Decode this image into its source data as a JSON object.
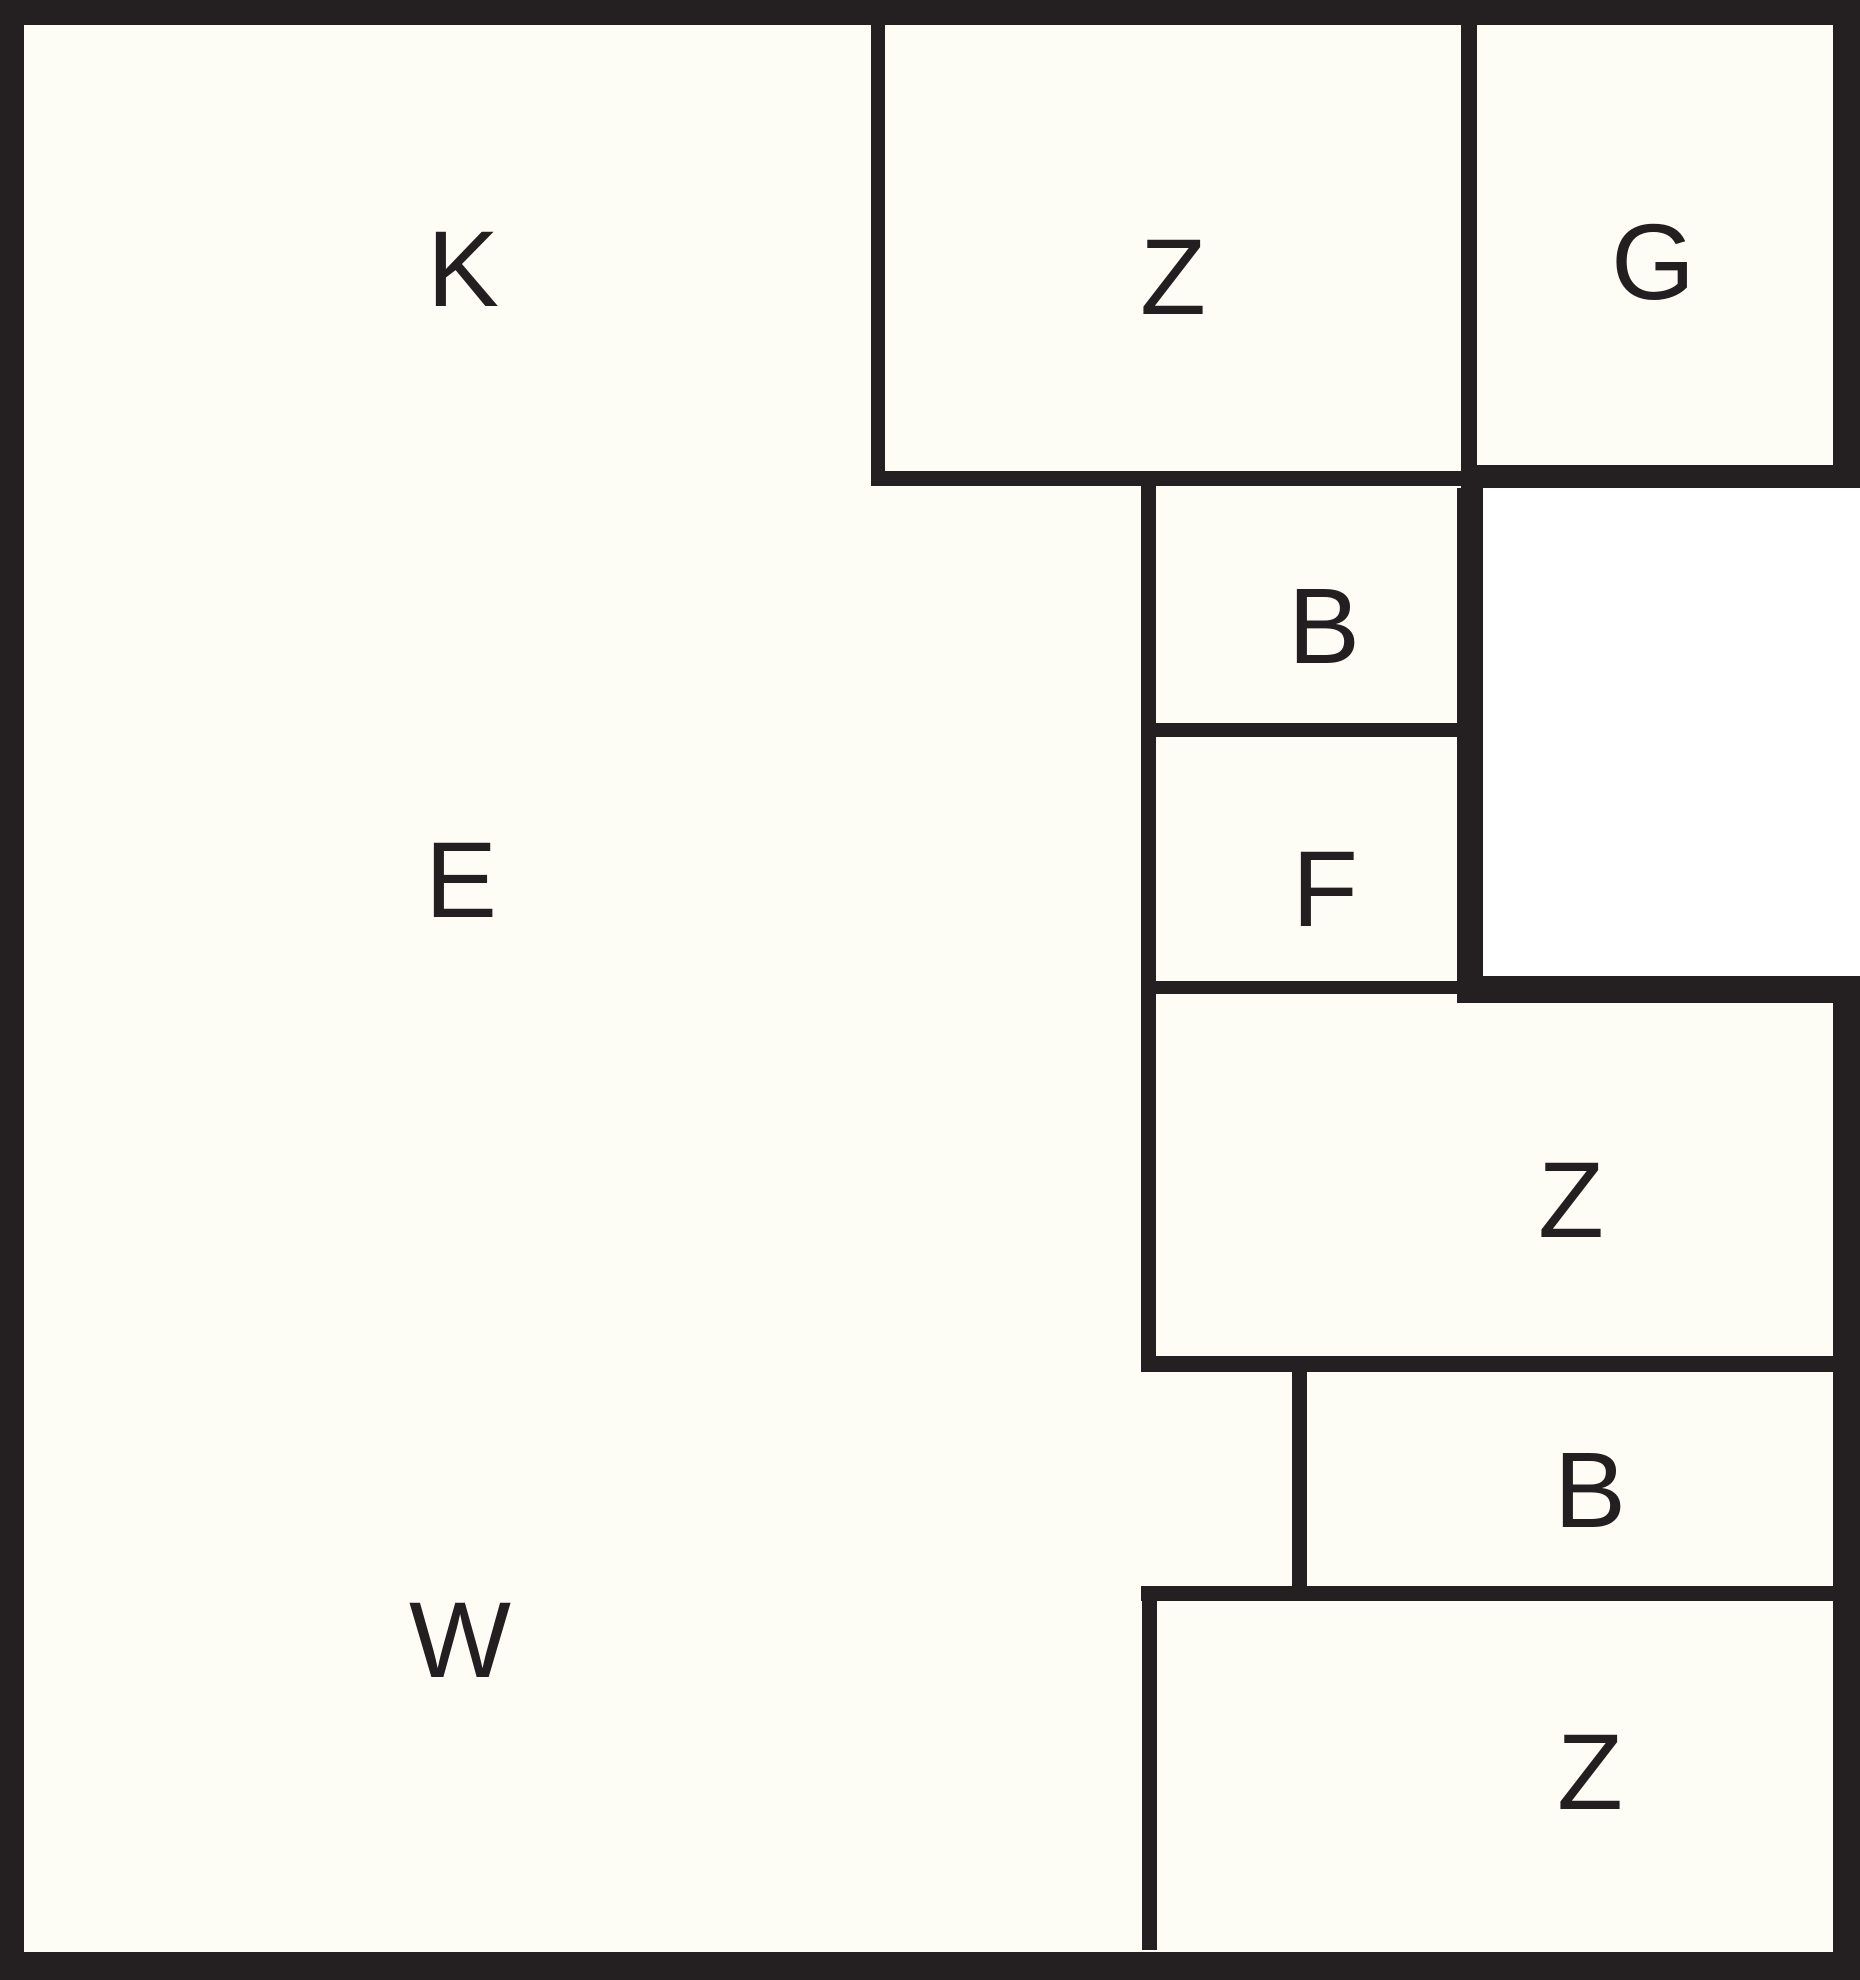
{
  "canvas": {
    "width": 1860,
    "height": 1980
  },
  "colors": {
    "wall": "#241f20",
    "floor": "#fdfdf5",
    "exterior": "#ffffff",
    "label_text": "#231f20"
  },
  "regions": [
    {
      "name": "floor-interior",
      "x": 24,
      "y": 25,
      "w": 1809,
      "h": 1927,
      "fill": "floor"
    },
    {
      "name": "exterior-notch",
      "x": 1483,
      "y": 488,
      "w": 377,
      "h": 488,
      "fill": "exterior"
    }
  ],
  "walls": [
    {
      "name": "outer-wall-top",
      "x": 0,
      "y": 0,
      "w": 1860,
      "h": 25
    },
    {
      "name": "outer-wall-left",
      "x": 0,
      "y": 0,
      "w": 24,
      "h": 1980
    },
    {
      "name": "outer-wall-bottom",
      "x": 0,
      "y": 1952,
      "w": 1860,
      "h": 28
    },
    {
      "name": "outer-wall-right-upper",
      "x": 1833,
      "y": 0,
      "w": 27,
      "h": 488
    },
    {
      "name": "outer-wall-right-lower",
      "x": 1833,
      "y": 976,
      "w": 27,
      "h": 1004
    },
    {
      "name": "wall-k-z",
      "x": 871,
      "y": 25,
      "w": 14,
      "h": 446
    },
    {
      "name": "wall-below-top-z",
      "x": 871,
      "y": 471,
      "w": 590,
      "h": 15
    },
    {
      "name": "wall-z-g",
      "x": 1461,
      "y": 25,
      "w": 16,
      "h": 440
    },
    {
      "name": "wall-below-g",
      "x": 1461,
      "y": 465,
      "w": 399,
      "h": 23
    },
    {
      "name": "wall-bf-left",
      "x": 1141,
      "y": 486,
      "w": 15,
      "h": 870
    },
    {
      "name": "wall-b-f-divider",
      "x": 1156,
      "y": 723,
      "w": 301,
      "h": 14
    },
    {
      "name": "wall-below-f",
      "x": 1156,
      "y": 981,
      "w": 301,
      "h": 13
    },
    {
      "name": "wall-bf-right",
      "x": 1457,
      "y": 488,
      "w": 26,
      "h": 515
    },
    {
      "name": "wall-mid-z-top",
      "x": 1457,
      "y": 976,
      "w": 403,
      "h": 27
    },
    {
      "name": "wall-mid-z-bottom",
      "x": 1141,
      "y": 1356,
      "w": 692,
      "h": 16
    },
    {
      "name": "wall-lower-b-left",
      "x": 1292,
      "y": 1372,
      "w": 15,
      "h": 214
    },
    {
      "name": "wall-lower-b-bottom",
      "x": 1141,
      "y": 1586,
      "w": 692,
      "h": 15
    },
    {
      "name": "wall-bottom-z-left",
      "x": 1142,
      "y": 1601,
      "w": 15,
      "h": 349
    }
  ],
  "labels": [
    {
      "name": "room-label-k",
      "text": "K",
      "x": 463,
      "y": 269
    },
    {
      "name": "room-label-top-z",
      "text": "Z",
      "x": 1173,
      "y": 277
    },
    {
      "name": "room-label-g",
      "text": "G",
      "x": 1653,
      "y": 262
    },
    {
      "name": "room-label-upper-b",
      "text": "B",
      "x": 1324,
      "y": 626
    },
    {
      "name": "room-label-e",
      "text": "E",
      "x": 461,
      "y": 880
    },
    {
      "name": "room-label-f",
      "text": "F",
      "x": 1325,
      "y": 889
    },
    {
      "name": "room-label-mid-z",
      "text": "Z",
      "x": 1571,
      "y": 1200
    },
    {
      "name": "room-label-lower-b",
      "text": "B",
      "x": 1590,
      "y": 1490
    },
    {
      "name": "room-label-w",
      "text": "W",
      "x": 460,
      "y": 1640
    },
    {
      "name": "room-label-bottom-z",
      "text": "Z",
      "x": 1590,
      "y": 1772
    }
  ]
}
